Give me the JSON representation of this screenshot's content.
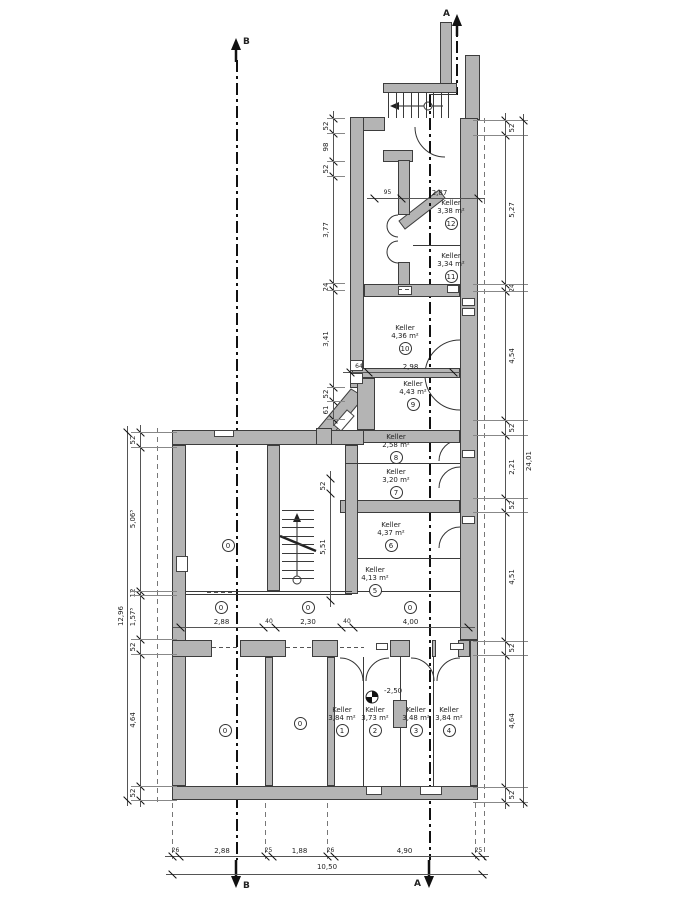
{
  "plan": {
    "section_markers": {
      "a": "A",
      "b": "B"
    },
    "level_label": "-2,50",
    "rooms": [
      {
        "no": "1",
        "name": "Keller",
        "area": "3,84 m²"
      },
      {
        "no": "2",
        "name": "Keller",
        "area": "3,73 m²"
      },
      {
        "no": "3",
        "name": "Keller",
        "area": "3,48 m²"
      },
      {
        "no": "4",
        "name": "Keller",
        "area": "3,84 m²"
      },
      {
        "no": "5",
        "name": "Keller",
        "area": "4,13 m²"
      },
      {
        "no": "6",
        "name": "Keller",
        "area": "4,37 m²"
      },
      {
        "no": "7",
        "name": "Keller",
        "area": "3,20 m²"
      },
      {
        "no": "8",
        "name": "Keller",
        "area": "2,58 m²"
      },
      {
        "no": "9",
        "name": "Keller",
        "area": "4,43 m²"
      },
      {
        "no": "10",
        "name": "Keller",
        "area": "4,36 m²"
      },
      {
        "no": "11",
        "name": "Keller",
        "area": "3,34 m²"
      },
      {
        "no": "12",
        "name": "Keller",
        "area": "3,38 m²"
      }
    ],
    "zero_markers": [
      "0",
      "0",
      "0"
    ],
    "dims": {
      "left": {
        "segments": [
          "52",
          "5,06⁵",
          "12",
          "1,57⁵",
          "52",
          "4,64",
          "52"
        ],
        "total": "12,96"
      },
      "right": {
        "segments": [
          "52",
          "5,27",
          "24",
          "4,54",
          "52",
          "2,21",
          "52",
          "4,51",
          "52",
          "4,64",
          "52"
        ],
        "total": "24,01"
      },
      "inner_left": {
        "segments": [
          "52",
          "98",
          "52",
          "3,77",
          "24",
          "3,41",
          "52",
          "61"
        ]
      },
      "bottom": {
        "segments": [
          "26",
          "2,88",
          "25",
          "1,88",
          "26",
          "4,90",
          "25"
        ],
        "total": "10,50"
      },
      "middle_row": {
        "segments": [
          "2,88",
          "40",
          "2,30",
          "40",
          "4,00"
        ],
        "circles": [
          "0",
          "0",
          "0"
        ]
      },
      "top": {
        "segments": [
          "95",
          "2,87"
        ]
      },
      "room9_width": {
        "segments": [
          "64",
          "2,98"
        ]
      },
      "stair_hall": {
        "segments": [
          "52",
          "5,51"
        ]
      }
    }
  }
}
